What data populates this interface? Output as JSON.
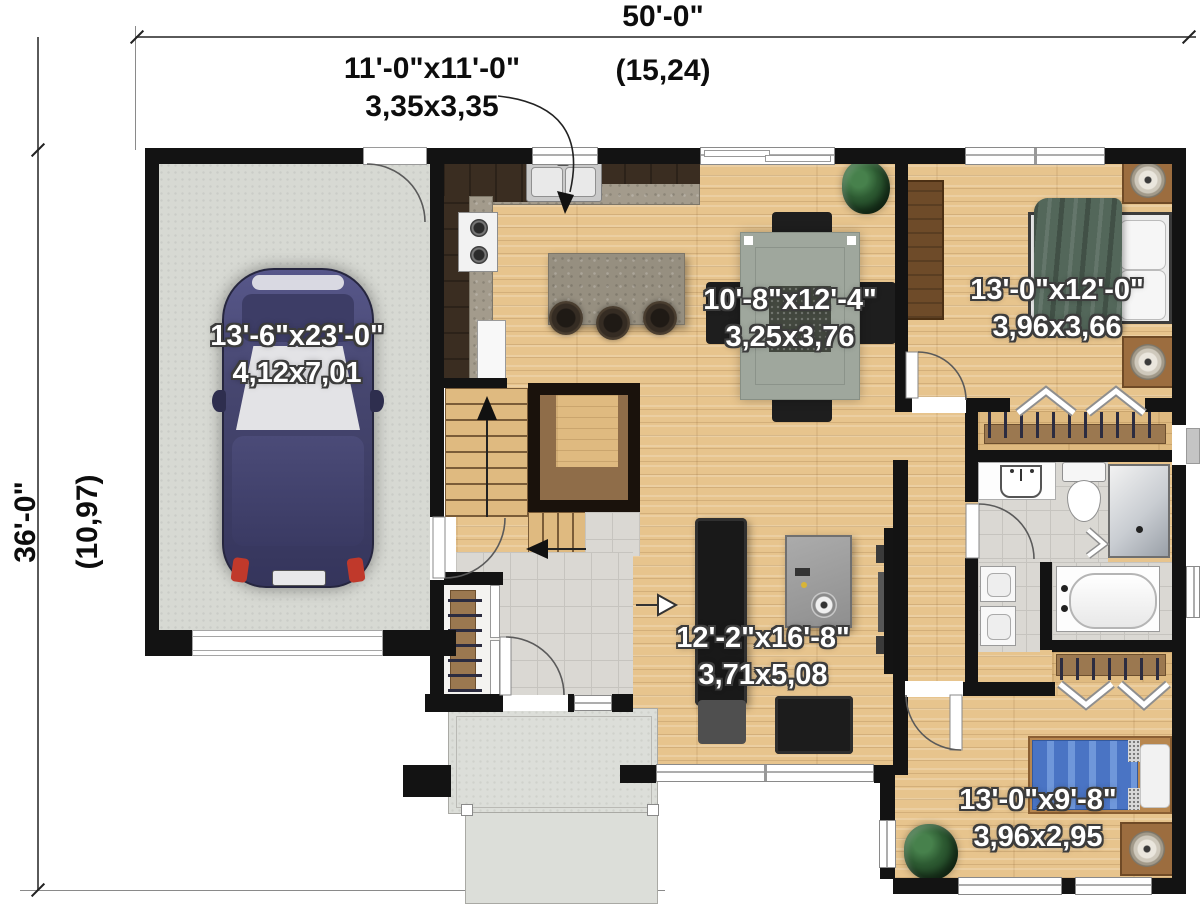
{
  "plan": {
    "overall_width": {
      "imperial": "50'-0\"",
      "metric": "(15,24)"
    },
    "overall_depth": {
      "imperial": "36'-0\"",
      "metric": "(10,97)"
    },
    "rooms": {
      "kitchen": {
        "imperial": "11'-0\"x11'-0\"",
        "metric": "3,35x3,35"
      },
      "garage": {
        "imperial": "13'-6\"x23'-0\"",
        "metric": "4,12x7,01"
      },
      "dining": {
        "imperial": "10'-8\"x12'-4\"",
        "metric": "3,25x3,76"
      },
      "primary_bedroom": {
        "imperial": "13'-0\"x12'-0\"",
        "metric": "3,96x3,66"
      },
      "living": {
        "imperial": "12'-2\"x16'-8\"",
        "metric": "3,71x5,08"
      },
      "second_bedroom": {
        "imperial": "13'-0\"x9'-8\"",
        "metric": "3,96x2,95"
      }
    },
    "colors": {
      "wall": "#131313",
      "wood_floor": "#e7c48d",
      "garage_floor": "#d7d9d3",
      "tile_floor": "#dad8d3",
      "counter_granite": "#a39b8c",
      "cabinet_dark": "#3a2d21",
      "bed_blanket_green": "#53675a",
      "bed_blue": "#4a74c4",
      "car_body": "#42426b",
      "label_text": "#ffffff",
      "dimension_text": "#0d0d0d"
    }
  }
}
